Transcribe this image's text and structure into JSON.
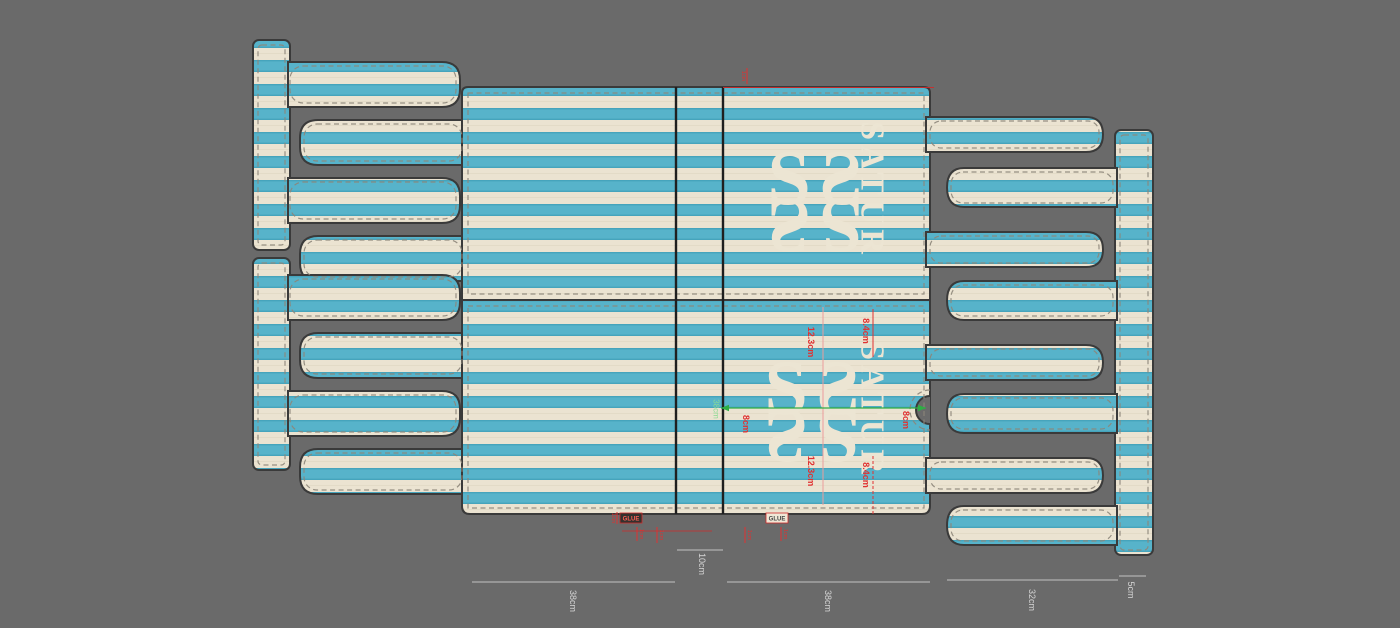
{
  "colors": {
    "background": "#6a6a6a",
    "stripe_cream": "#ebe3d1",
    "stripe_blue": "#57b3ca",
    "outline": "#3a3a3a",
    "dashed_fold": "#8d867a",
    "annotation_red": "#e03131",
    "annotation_pink": "#eb9c9c",
    "annotation_green": "#2fae44",
    "dimension_gray": "#d6d6d6"
  },
  "brand": {
    "name_top": "SATUR",
    "name_bottom": "SATUR",
    "ornament_glyph": "S"
  },
  "measurements": {
    "green_panel_width": "38cm",
    "red_dims": {
      "top_right": "8.4cm",
      "top_mid": "12.3cm",
      "left": "8cm",
      "right": "8cm",
      "bottom_mid": "12.3cm",
      "bottom_right": "8.4cm"
    },
    "micro_tick": "1cm",
    "glue_label_left": "GLUE",
    "glue_label_right": "GLUE"
  },
  "bottom_dimensions": [
    {
      "label": "38cm"
    },
    {
      "label": "10cm"
    },
    {
      "label": "38cm"
    },
    {
      "label": "32cm"
    },
    {
      "label": "5cm"
    }
  ]
}
